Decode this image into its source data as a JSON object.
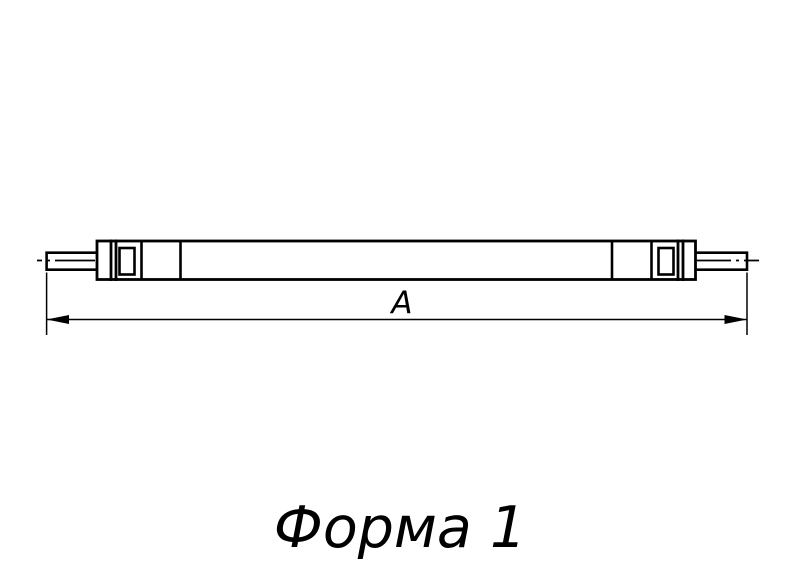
{
  "figure": {
    "dimension_label": "A",
    "caption": "Форма 1"
  },
  "drawing": {
    "type": "technical-drawing-tie-rod",
    "linework": {
      "outline_color": "#000000",
      "background_color": "#ffffff",
      "centerline_style": "dash-dot"
    }
  }
}
